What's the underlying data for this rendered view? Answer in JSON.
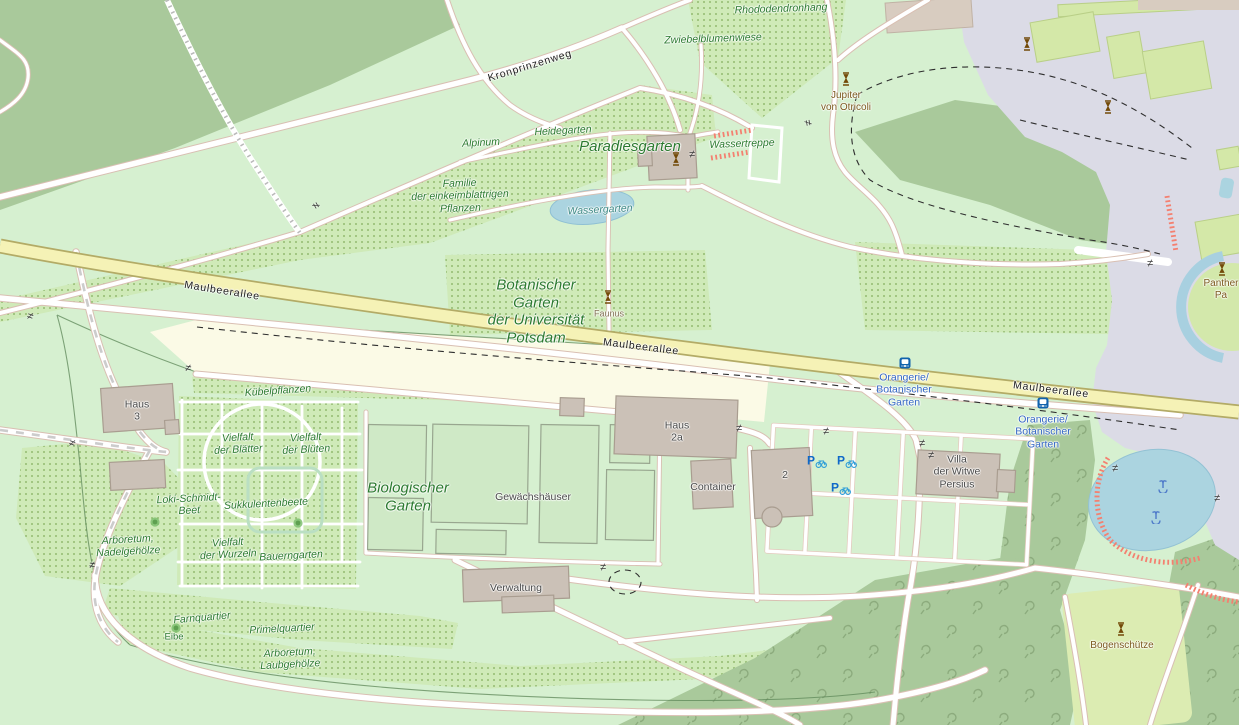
{
  "map": {
    "title": "Botanischer Garten der Universität Potsdam map view",
    "colors": {
      "base_green": "#d6f0d0",
      "forest_green": "#a9c99b",
      "scrub_dot_green": "#93bb70",
      "lawn_green": "#dcecb2",
      "farmland_cream": "#fbfae6",
      "secondary_road_yellow": "#f5f2b6",
      "pedestrian_gray": "#dbdbe6",
      "water_blue": "#abd4e0",
      "building_gray": "#cbc1b7",
      "steps_salmon": "#f48070",
      "transit_blue": "#3568c5",
      "statue_brown": "#734a08",
      "garden_label_green": "#2b7a2f"
    },
    "labels": [
      {
        "name": "rhododendronhang",
        "text": "Rhododendronhang",
        "x": 781,
        "y": 9,
        "cls": "lb-garden",
        "rot": -2
      },
      {
        "name": "zwiebelblumenwiese",
        "text": "Zwiebelblumenwiese",
        "x": 713,
        "y": 39,
        "cls": "lb-garden",
        "rot": -2
      },
      {
        "name": "kronprinzenweg",
        "text": "Kronprinzenweg",
        "x": 530,
        "y": 66,
        "cls": "lb-road",
        "rot": -17
      },
      {
        "name": "heidegarten",
        "text": "Heidegarten",
        "x": 563,
        "y": 131,
        "cls": "lb-garden",
        "rot": -3
      },
      {
        "name": "alpinum",
        "text": "Alpinum",
        "x": 481,
        "y": 143,
        "cls": "lb-garden",
        "rot": -3
      },
      {
        "name": "paradiesgarten",
        "text": "Paradiesgarten",
        "x": 630,
        "y": 147,
        "cls": "lb-garden-lg",
        "rot": 0
      },
      {
        "name": "wassertreppe",
        "text": "Wassertreppe",
        "x": 742,
        "y": 144,
        "cls": "lb-garden",
        "rot": -2
      },
      {
        "name": "familie-einkeimblattrige",
        "text": "Familie\nder einkeimblattrigen\nPflanzen",
        "x": 460,
        "y": 196,
        "cls": "lb-garden",
        "rot": -2
      },
      {
        "name": "wassergarten",
        "text": "Wassergarten",
        "x": 600,
        "y": 210,
        "cls": "lb-water",
        "rot": -3
      },
      {
        "name": "jupiter-von-otricoli",
        "text": "Jupiter\nvon Otricoli",
        "x": 846,
        "y": 102,
        "cls": "lb-brown",
        "rot": 0
      },
      {
        "name": "botanischer-garten",
        "text": "Botanischer\nGarten\nder Universität\nPotsdam",
        "x": 536,
        "y": 312,
        "cls": "lb-garden-lg",
        "rot": 0
      },
      {
        "name": "maulbeerallee-west",
        "text": "Maulbeerallee",
        "x": 222,
        "y": 291,
        "cls": "lb-road",
        "rot": 9
      },
      {
        "name": "maulbeerallee-mid",
        "text": "Maulbeerallee",
        "x": 641,
        "y": 347,
        "cls": "lb-road",
        "rot": 7
      },
      {
        "name": "maulbeerallee-east",
        "text": "Maulbeerallee",
        "x": 1051,
        "y": 390,
        "cls": "lb-road",
        "rot": 7
      },
      {
        "name": "faunus",
        "text": "Faunus",
        "x": 609,
        "y": 314,
        "cls": "lb-brown-sm",
        "rot": 0
      },
      {
        "name": "kuebelpflanzen",
        "text": "Kübelpflanzen",
        "x": 278,
        "y": 391,
        "cls": "lb-garden",
        "rot": -4
      },
      {
        "name": "haus-3",
        "text": "Haus\n3",
        "x": 137,
        "y": 411,
        "cls": "lb-bldg",
        "rot": 0
      },
      {
        "name": "vielfalt-der-blaetter",
        "text": "Vielfalt\nder Blätter",
        "x": 238,
        "y": 444,
        "cls": "lb-garden",
        "rot": -3
      },
      {
        "name": "vielfalt-der-blueten",
        "text": "Vielfalt\nder Blüten",
        "x": 306,
        "y": 444,
        "cls": "lb-garden",
        "rot": -3
      },
      {
        "name": "loki-schmidt-beet",
        "text": "Loki-Schmidt-\nBeet",
        "x": 189,
        "y": 505,
        "cls": "lb-garden",
        "rot": -3
      },
      {
        "name": "sukkulentenbeete",
        "text": "Sukkulentenbeete",
        "x": 266,
        "y": 504,
        "cls": "lb-garden",
        "rot": -3
      },
      {
        "name": "biologischer-garten",
        "text": "Biologischer\nGarten",
        "x": 408,
        "y": 497,
        "cls": "lb-garden-lg",
        "rot": 0
      },
      {
        "name": "gewaechshaeuser",
        "text": "Gewächshäuser",
        "x": 533,
        "y": 497,
        "cls": "lb-bldg",
        "rot": 0
      },
      {
        "name": "haus-2a",
        "text": "Haus\n2a",
        "x": 677,
        "y": 432,
        "cls": "lb-bldg",
        "rot": 0
      },
      {
        "name": "container",
        "text": "Container",
        "x": 713,
        "y": 487,
        "cls": "lb-bldg",
        "rot": 0
      },
      {
        "name": "building-2",
        "text": "2",
        "x": 785,
        "y": 475,
        "cls": "lb-bldg",
        "rot": 0
      },
      {
        "name": "orangerie-stop-north",
        "text": "Orangerie/\nBotanischer\nGarten",
        "x": 904,
        "y": 390,
        "cls": "lb-transit",
        "rot": 0
      },
      {
        "name": "orangerie-stop-south",
        "text": "Orangerie/\nBotanischer\nGarten",
        "x": 1043,
        "y": 432,
        "cls": "lb-transit",
        "rot": 0
      },
      {
        "name": "villa-der-witwe-persius",
        "text": "Villa\nder Witwe\nPersius",
        "x": 957,
        "y": 472,
        "cls": "lb-bldg",
        "rot": 0
      },
      {
        "name": "arboretum-nadelgehoelze",
        "text": "Arboretum,\nNadelgehölze",
        "x": 128,
        "y": 546,
        "cls": "lb-garden",
        "rot": -3
      },
      {
        "name": "vielfalt-der-wurzeln",
        "text": "Vielfalt\nder Wurzeln",
        "x": 228,
        "y": 549,
        "cls": "lb-garden",
        "rot": -3
      },
      {
        "name": "bauerngarten",
        "text": "Bauerngarten",
        "x": 291,
        "y": 556,
        "cls": "lb-garden",
        "rot": -3
      },
      {
        "name": "verwaltung",
        "text": "Verwaltung",
        "x": 516,
        "y": 588,
        "cls": "lb-bldg",
        "rot": 0
      },
      {
        "name": "farnquartier",
        "text": "Farnquartier",
        "x": 202,
        "y": 618,
        "cls": "lb-garden",
        "rot": -5
      },
      {
        "name": "eibe",
        "text": "Eibe",
        "x": 174,
        "y": 637,
        "cls": "lb-garden-sm",
        "rot": 0
      },
      {
        "name": "primelquartier",
        "text": "Primelquartier",
        "x": 282,
        "y": 629,
        "cls": "lb-garden",
        "rot": -3
      },
      {
        "name": "arboretum-laubgehoelze",
        "text": "Arboretum,\nLaubgehölze",
        "x": 290,
        "y": 659,
        "cls": "lb-garden",
        "rot": -3
      },
      {
        "name": "bogenschuetze",
        "text": "Bogenschütze",
        "x": 1122,
        "y": 646,
        "cls": "lb-brown",
        "rot": 0
      },
      {
        "name": "panther",
        "text": "Panther\nPa",
        "x": 1221,
        "y": 290,
        "cls": "lb-brown",
        "rot": 0
      }
    ],
    "icons": [
      {
        "type": "statue",
        "x": 676,
        "y": 159
      },
      {
        "type": "statue",
        "x": 608,
        "y": 297
      },
      {
        "type": "statue",
        "x": 846,
        "y": 79
      },
      {
        "type": "statue",
        "x": 1027,
        "y": 44
      },
      {
        "type": "statue",
        "x": 1108,
        "y": 107
      },
      {
        "type": "statue",
        "x": 1222,
        "y": 269
      },
      {
        "type": "statue",
        "x": 1121,
        "y": 629
      },
      {
        "type": "bus",
        "x": 905,
        "y": 363
      },
      {
        "type": "bus",
        "x": 1043,
        "y": 403
      },
      {
        "type": "bike",
        "x": 817,
        "y": 461
      },
      {
        "type": "bike",
        "x": 847,
        "y": 461
      },
      {
        "type": "bike",
        "x": 841,
        "y": 488
      },
      {
        "type": "fountain",
        "x": 1163,
        "y": 486
      },
      {
        "type": "fountain",
        "x": 1156,
        "y": 517
      },
      {
        "type": "tree",
        "x": 155,
        "y": 522
      },
      {
        "type": "tree",
        "x": 298,
        "y": 523
      },
      {
        "type": "tree",
        "x": 176,
        "y": 628
      },
      {
        "type": "gate",
        "x": 30,
        "y": 317,
        "rot": 20
      },
      {
        "type": "gate",
        "x": 188,
        "y": 369,
        "rot": 10
      },
      {
        "type": "gate",
        "x": 315,
        "y": 206,
        "rot": 60
      },
      {
        "type": "gate",
        "x": 692,
        "y": 155,
        "rot": 0
      },
      {
        "type": "gate",
        "x": 807,
        "y": 123,
        "rot": 80
      },
      {
        "type": "gate",
        "x": 739,
        "y": 429,
        "rot": 0
      },
      {
        "type": "gate",
        "x": 826,
        "y": 432,
        "rot": 0
      },
      {
        "type": "gate",
        "x": 922,
        "y": 444,
        "rot": 0
      },
      {
        "type": "gate",
        "x": 931,
        "y": 456,
        "rot": 0
      },
      {
        "type": "gate",
        "x": 72,
        "y": 444,
        "rot": 20
      },
      {
        "type": "gate",
        "x": 92,
        "y": 566,
        "rot": 10
      },
      {
        "type": "gate",
        "x": 603,
        "y": 568,
        "rot": 0
      },
      {
        "type": "gate",
        "x": 1115,
        "y": 469,
        "rot": 0
      },
      {
        "type": "gate",
        "x": 1217,
        "y": 499,
        "rot": 0
      },
      {
        "type": "gate",
        "x": 1150,
        "y": 264,
        "rot": 0
      }
    ]
  }
}
